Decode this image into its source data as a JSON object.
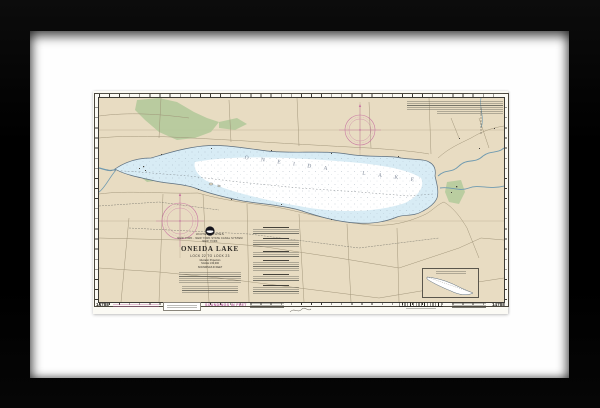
{
  "artwork": {
    "kind": "framed NOAA nautical chart print",
    "frame_color": "#000000",
    "mat_color": "#fefefe",
    "paper_color": "#fbfaf4"
  },
  "chart": {
    "number": "14788",
    "agency_line1": "UNITED STATES",
    "agency_line2": "NEW YORK - NEW YORK STATE CANAL SYSTEM",
    "agency_line3": "NEW YORK",
    "title": "ONEIDA LAKE",
    "subtitle": "LOCK 22 TO LOCK 23",
    "projection_line": "Mercator Projection",
    "scale_line": "SCALE 1:60,000",
    "soundings_note": "SOUNDINGS IN FEET",
    "lake_label": "ONEIDA LAKE",
    "colors": {
      "land_buff": "#e8dcc2",
      "shallow_water": "#d8ecf5",
      "deep_water": "#ffffff",
      "vegetation_green": "#b7cb9e",
      "compass_magenta": "#c4699f",
      "shoreline": "#5c6e7e"
    }
  }
}
